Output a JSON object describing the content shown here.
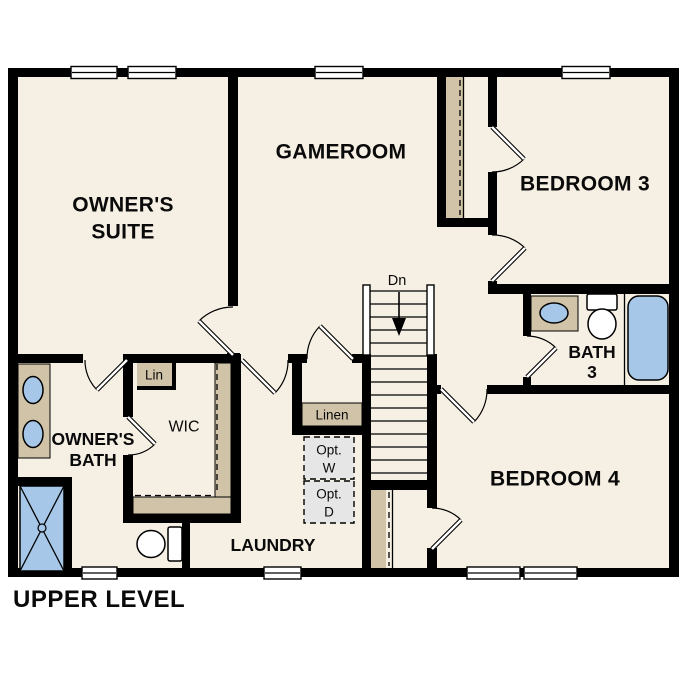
{
  "title": "UPPER LEVEL",
  "rooms": {
    "owners_suite": {
      "line1": "OWNER'S",
      "line2": "SUITE"
    },
    "gameroom": {
      "label": "GAMEROOM"
    },
    "bedroom3": {
      "label": "BEDROOM 3"
    },
    "bedroom4": {
      "label": "BEDROOM 4"
    },
    "owners_bath": {
      "line1": "OWNER'S",
      "line2": "BATH"
    },
    "bath3": {
      "line1": "BATH",
      "line2": "3"
    },
    "wic": {
      "label": "WIC"
    },
    "laundry": {
      "label": "LAUNDRY"
    }
  },
  "closets": {
    "lin": "Lin",
    "linen": "Linen"
  },
  "optional_appliances": {
    "washer": {
      "line1": "Opt.",
      "line2": "W"
    },
    "dryer": {
      "line1": "Opt.",
      "line2": "D"
    }
  },
  "stairs": {
    "direction_label": "Dn"
  },
  "colors": {
    "background": "#ffffff",
    "floor": "#f6efe4",
    "wall": "#000000",
    "casework_tan": "#d0c3a8",
    "fixture_blue": "#a6c7e8",
    "optional_gray": "#e6e6e6"
  }
}
